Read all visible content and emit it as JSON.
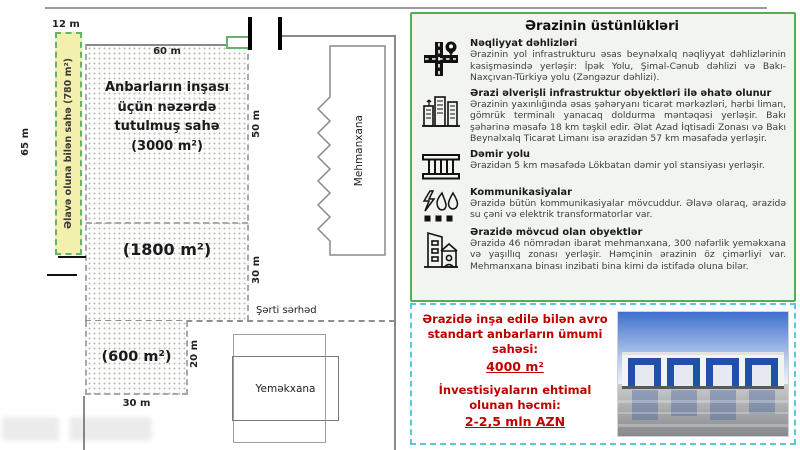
{
  "colors": {
    "accent_green": "#57ad57",
    "accent_cyan": "#5bc8d8",
    "accent_red": "#c00000",
    "extra_area_yellow": "#f3efad"
  },
  "diagram": {
    "labels": {
      "top_width": "12 m",
      "plot_width": "60 m",
      "left_height": "65 m",
      "upper_right_height": "50 m",
      "lower_right_height": "30 m",
      "small_plot_height": "20 m",
      "bottom_width": "30 m",
      "conditional_border": "Şərti sərhəd"
    },
    "areas": {
      "extra": "Əlavə oluna bilən sahə (780 m²)",
      "main": "Anbarların inşası üçün nəzərdə tutulmuş sahə (3000 m²)",
      "middle": "(1800 m²)",
      "small": "(600 m²)"
    },
    "buildings": {
      "hotel": "Mehmanxana",
      "canteen": "Yeməkxana"
    }
  },
  "advantages": {
    "title": "Ərazinin üstünlükləri",
    "sections": [
      {
        "icon": "crossroads-pin-icon",
        "heading": "Nəqliyyat dəhlizləri",
        "body": "Ərazinin yol infrastrukturu əsas beynəlxalq nəqliyyat dəhlizlərinin kəsişməsində yerləşir: İpək Yolu, Şimal-Cənub dəhlizi və Bakı-Naxçıvan-Türkiyə yolu (Zəngəzur dəhlizi)."
      },
      {
        "icon": "city-buildings-icon",
        "heading": "Ərazi əlverişli infrastruktur obyektləri ilə əhatə olunur",
        "body": "Ərazinin yaxınlığında əsas şəhəryanı ticarət mərkəzləri, hərbi liman, gömrük terminalı yanacaq doldurma məntəqəsi yerləşir. Bakı şəhərinə məsafə 18 km təşkil edir. Ələt Azad İqtisadi Zonası və Bakı Beynəlxalq Ticarət Limanı isə ərazidən 57 km məsafədə yerləşir."
      },
      {
        "icon": "railway-icon",
        "heading": "Dəmir yolu",
        "body": "Ərazidən 5 km məsafədə Lökbatan dəmir yol stansiyası yerləşir."
      },
      {
        "icon": "utilities-icon",
        "heading": "Kommunikasiyalar",
        "body": "Ərazidə bütün kommunikasiyalar mövcuddur. Əlavə olaraq, ərazidə su çəni və elektrik transformatorlar var."
      },
      {
        "icon": "site-buildings-icon",
        "heading": "Ərazidə mövcud olan obyektlər",
        "body": "Ərazidə 46 nömrədən ibarət mehmanxana, 300 nəfərlik yeməkxana və yaşıllıq zonası yerləşir. Həmçinin ərazinin öz çimərliyi var. Mehmanxana binası inzibati bina kimi də istifadə oluna bilər."
      }
    ]
  },
  "investment": {
    "area_text": "Ərazidə inşa edilə bilən avro standart anbarların ümumi sahəsi:",
    "area_value": "4000 m²",
    "amount_text": "İnvestisiyaların ehtimal olunan həcmi:",
    "amount_value": "2-2,5 mln AZN",
    "photo": "warehouse-photo"
  }
}
